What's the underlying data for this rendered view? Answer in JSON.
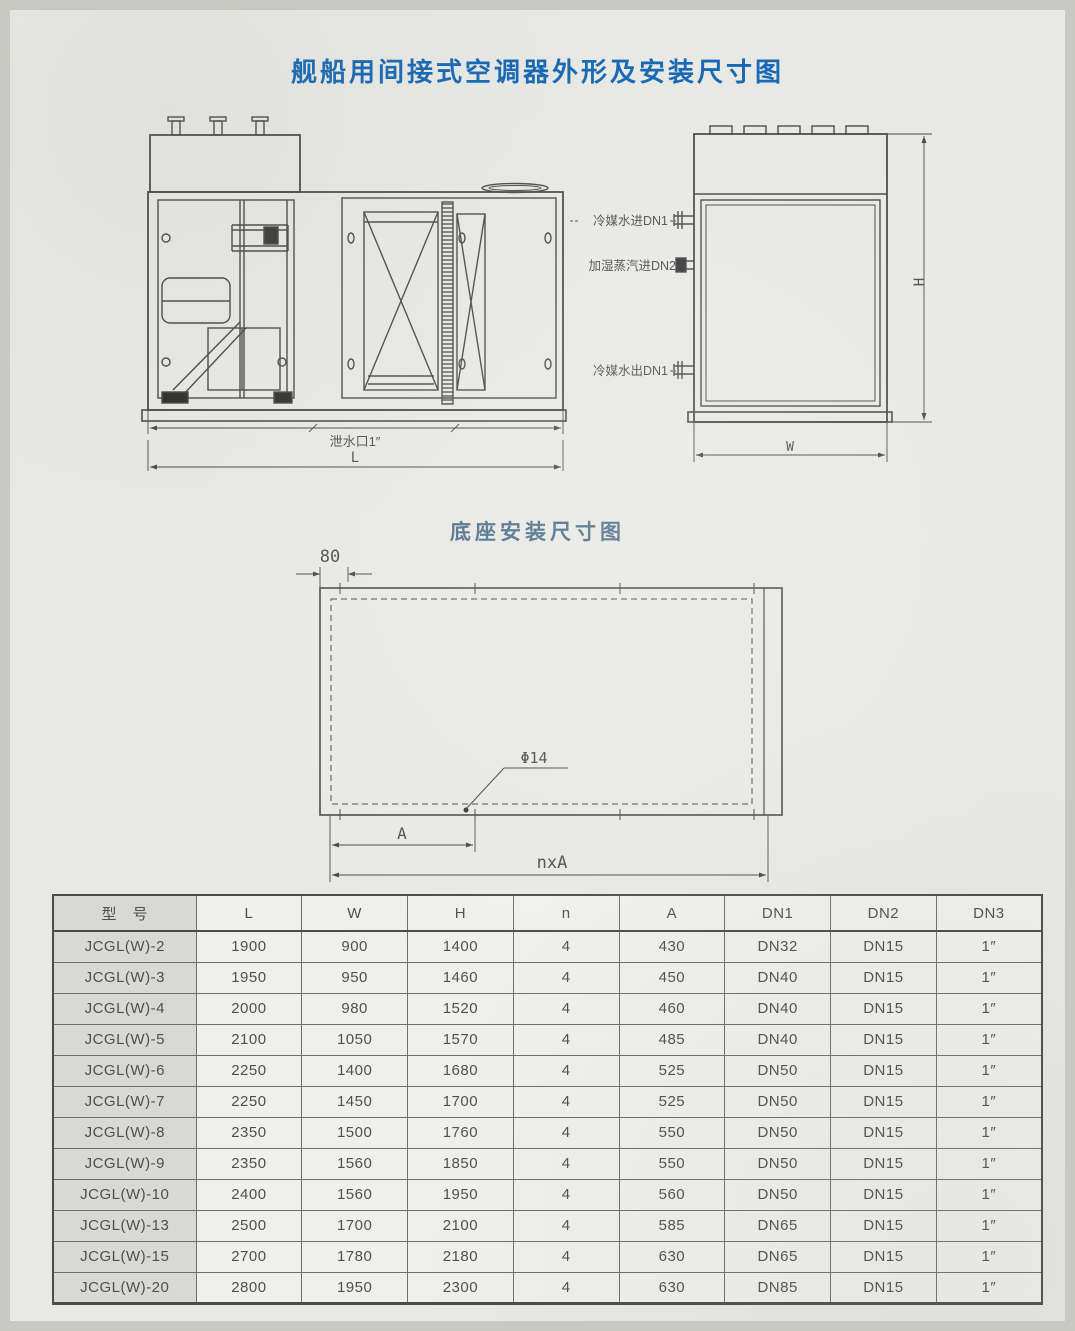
{
  "page": {
    "title": "舰船用间接式空调器外形及安装尺寸图",
    "subtitle": "底座安装尺寸图"
  },
  "outline": {
    "pipe_labels": {
      "chilled_water_in": "冷媒水进DN1",
      "steam_in": "加湿蒸汽进DN2",
      "chilled_water_out": "冷媒水出DN1"
    },
    "drain_label": "泄水口1″",
    "dims": {
      "length": "L",
      "width": "W",
      "height": "H"
    }
  },
  "base_plan": {
    "edge_offset": "80",
    "hole_diameter": "Φ14",
    "hole_pitch": "A",
    "total_pitch": "nxA"
  },
  "table": {
    "headers": [
      "型　号",
      "L",
      "W",
      "H",
      "n",
      "A",
      "DN1",
      "DN2",
      "DN3"
    ],
    "rows": [
      [
        "JCGL(W)-2",
        "1900",
        "900",
        "1400",
        "4",
        "430",
        "DN32",
        "DN15",
        "1″"
      ],
      [
        "JCGL(W)-3",
        "1950",
        "950",
        "1460",
        "4",
        "450",
        "DN40",
        "DN15",
        "1″"
      ],
      [
        "JCGL(W)-4",
        "2000",
        "980",
        "1520",
        "4",
        "460",
        "DN40",
        "DN15",
        "1″"
      ],
      [
        "JCGL(W)-5",
        "2100",
        "1050",
        "1570",
        "4",
        "485",
        "DN40",
        "DN15",
        "1″"
      ],
      [
        "JCGL(W)-6",
        "2250",
        "1400",
        "1680",
        "4",
        "525",
        "DN50",
        "DN15",
        "1″"
      ],
      [
        "JCGL(W)-7",
        "2250",
        "1450",
        "1700",
        "4",
        "525",
        "DN50",
        "DN15",
        "1″"
      ],
      [
        "JCGL(W)-8",
        "2350",
        "1500",
        "1760",
        "4",
        "550",
        "DN50",
        "DN15",
        "1″"
      ],
      [
        "JCGL(W)-9",
        "2350",
        "1560",
        "1850",
        "4",
        "550",
        "DN50",
        "DN15",
        "1″"
      ],
      [
        "JCGL(W)-10",
        "2400",
        "1560",
        "1950",
        "4",
        "560",
        "DN50",
        "DN15",
        "1″"
      ],
      [
        "JCGL(W)-13",
        "2500",
        "1700",
        "2100",
        "4",
        "585",
        "DN65",
        "DN15",
        "1″"
      ],
      [
        "JCGL(W)-15",
        "2700",
        "1780",
        "2180",
        "4",
        "630",
        "DN65",
        "DN15",
        "1″"
      ],
      [
        "JCGL(W)-20",
        "2800",
        "1950",
        "2300",
        "4",
        "630",
        "DN85",
        "DN15",
        "1″"
      ]
    ]
  },
  "colors": {
    "title_blue": "#1668b3",
    "subtitle_blue": "#50708c",
    "line": "#4a4a4a",
    "page_bg": "#e8e8e4",
    "table_shade": "#d8d8d5",
    "cell_bg": "#efefec"
  }
}
